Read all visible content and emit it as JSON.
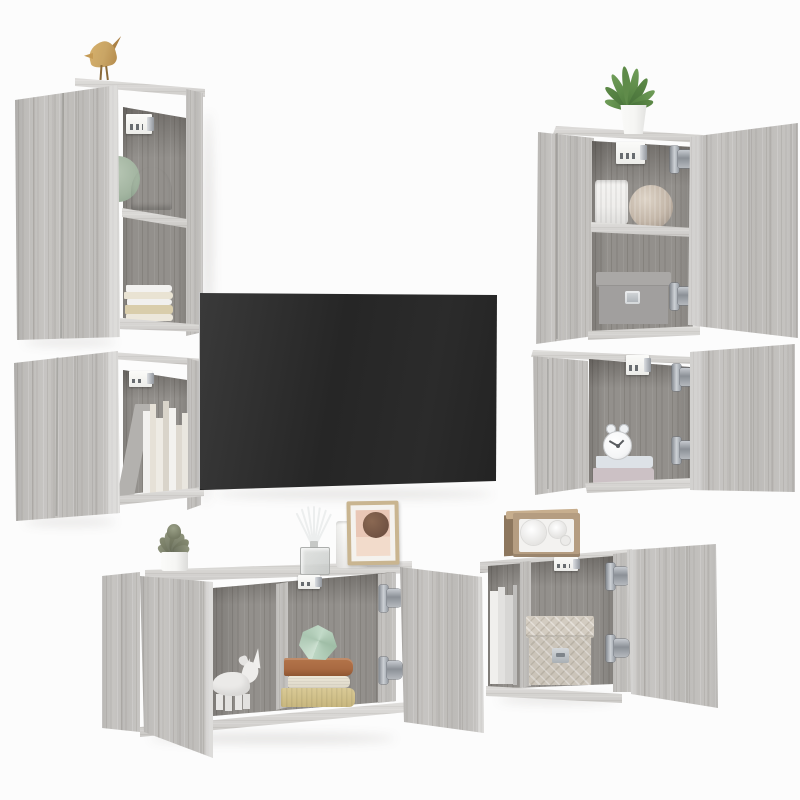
{
  "scene": {
    "description": "Product photo: 6-piece grey sonoma oak wall-mounted TV media wall set with open doors, a black flat-screen TV and decor items, on a white background",
    "units": [
      {
        "name": "wall-cabinet-tall-left",
        "contents": [
          "bird-figurine",
          "wall-mount-bracket",
          "green-plate",
          "fan-vase",
          "book-stack"
        ]
      },
      {
        "name": "wall-cabinet-small-left",
        "contents": [
          "wall-mount-bracket",
          "leaning-board",
          "book-row"
        ]
      },
      {
        "name": "tv-screen",
        "contents": []
      },
      {
        "name": "wall-cabinet-tall-right",
        "contents": [
          "potted-plant",
          "wall-mount-bracket",
          "ribbed-vase",
          "sphere-vase",
          "storage-box"
        ]
      },
      {
        "name": "wall-cabinet-small-right",
        "contents": [
          "wall-mount-bracket",
          "alarm-clock",
          "book-stack"
        ]
      },
      {
        "name": "tv-bench-left",
        "contents": [
          "succulent",
          "reed-diffuser",
          "white-cup",
          "picture-frame",
          "rhino-figurine",
          "geometric-ornament",
          "book-stack",
          "wall-mount-bracket",
          "door-hinges"
        ]
      },
      {
        "name": "tv-bench-right",
        "contents": [
          "radio",
          "file-boards",
          "fabric-storage-box",
          "wall-mount-bracket",
          "door-hinges"
        ]
      }
    ]
  },
  "colors": {
    "background": "#fcfcfc",
    "wood_light": "#c3c1be",
    "wood_top": "#d7d5d2",
    "wood_interior": "#93908c",
    "tv_screen": "#2b2b2b",
    "tv_bezel": "#c6c6c6",
    "bracket_white": "#ecece9",
    "bird_gold": "#c9a565",
    "plant_green": "#618c4c",
    "succulent_green": "#84896f",
    "pot_white": "#f5f5f3",
    "fan_vase_tan": "#b5988a",
    "sphere_vase_beige": "#c3b6a8",
    "ribbed_vase_white": "#efeeec",
    "storage_box_grey": "#a19f9e",
    "clock_white": "#f4f5f6",
    "book_orange": "#a96a42",
    "book_cream": "#ece7d9",
    "book_tan": "#d9ca96",
    "book_blue_grey": "#dde2e7",
    "book_pink_grey": "#ccc1c5",
    "gem_mint": "#bcd6c3",
    "fabric_box_beige": "#d3ccc1",
    "radio_wood": "#b59d81",
    "radio_face": "#f3f2f0",
    "frame_tan": "#c9b590",
    "art_pink": "#e9c7b6",
    "art_brown": "#6f5142",
    "glass": "#dfe1e0",
    "plate_sage": "#a3b5a1",
    "rhino_white": "#ebeae8"
  }
}
